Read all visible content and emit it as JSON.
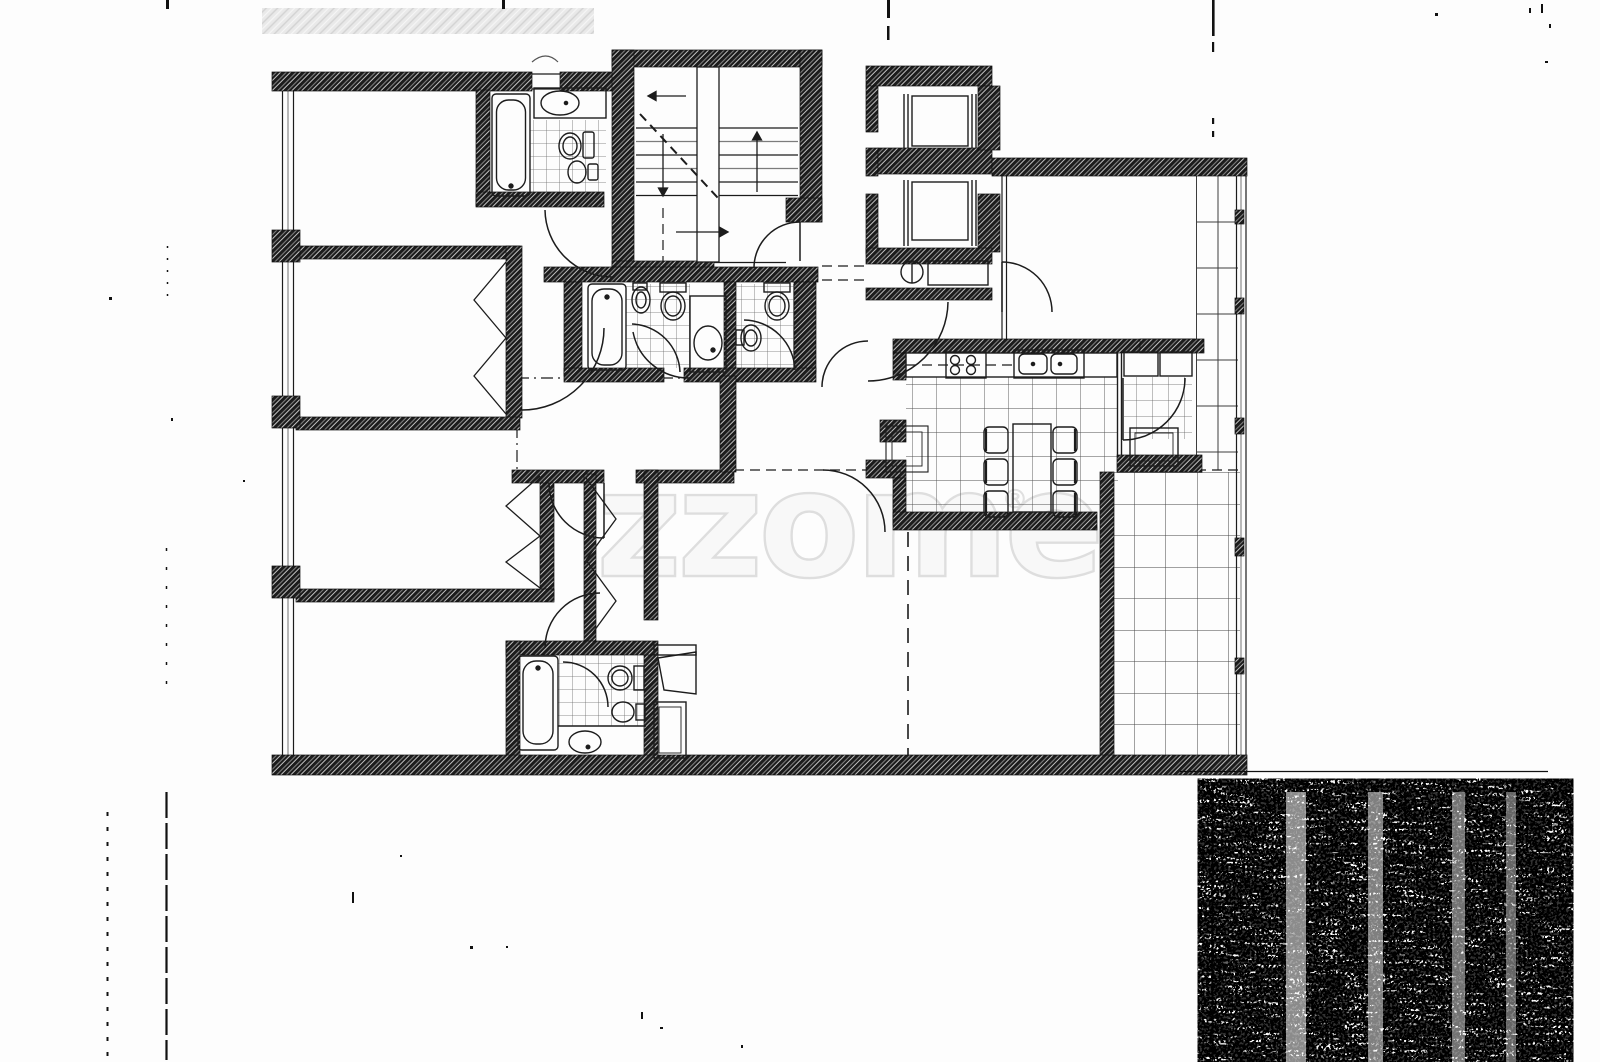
{
  "watermark": {
    "text": "zzome",
    "registered_mark": "®"
  },
  "palette": {
    "paper": "#fdfdfd",
    "ink": "#1c1c1c",
    "wall_fill": "#1b1b1b",
    "watermark_fill": "#f8f8f8",
    "watermark_stroke": "#dedede",
    "tile_line": "#6a6a6a"
  }
}
